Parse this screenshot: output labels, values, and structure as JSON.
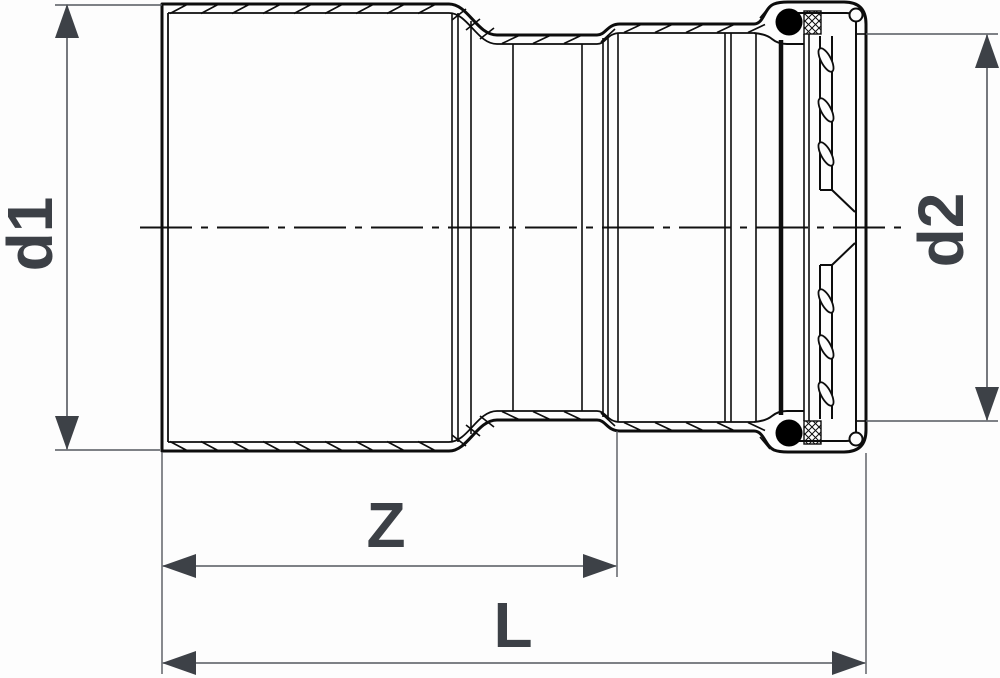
{
  "drawing": {
    "kind": "technical-section-drawing",
    "dimensions": {
      "d1": "d1",
      "d2": "d2",
      "z": "Z",
      "l": "L"
    },
    "colors": {
      "part_line": "#0d0d0d",
      "dimension_line": "#55585e",
      "dimension_text": "#3c4046",
      "arrow_fill": "#3d4147",
      "seal_fill": "#000000",
      "background": "#fdfdfd"
    }
  }
}
